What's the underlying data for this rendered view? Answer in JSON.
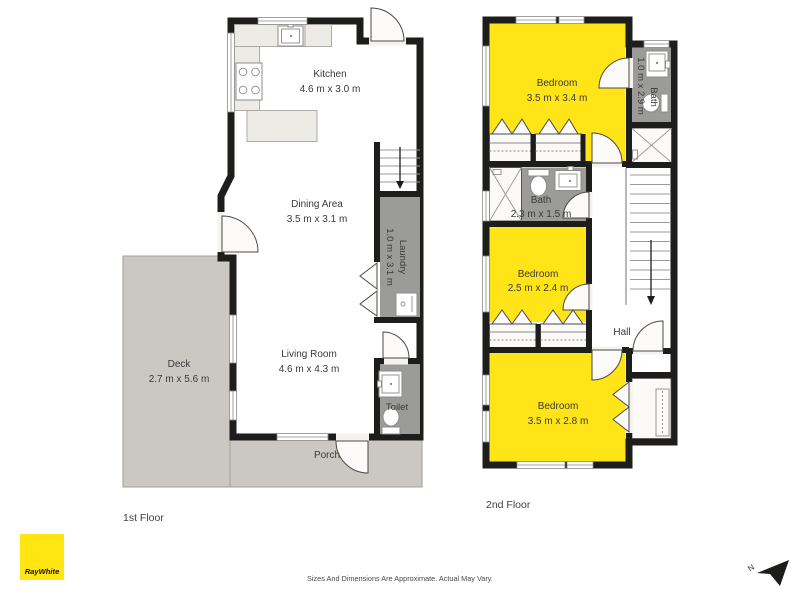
{
  "plan": {
    "floor1": {
      "label": "1st Floor",
      "kitchen": {
        "name": "Kitchen",
        "dims": "4.6 m x 3.0 m"
      },
      "dining": {
        "name": "Dining Area",
        "dims": "3.5 m x 3.1 m"
      },
      "laundry": {
        "name": "Laundry",
        "dims": "1.0 m x 3.1 m"
      },
      "living": {
        "name": "Living Room",
        "dims": "4.6 m x 4.3 m"
      },
      "toilet": {
        "name": "Toilet"
      },
      "deck": {
        "name": "Deck",
        "dims": "2.7 m x 5.6 m"
      },
      "porch": {
        "name": "Porch"
      }
    },
    "floor2": {
      "label": "2nd Floor",
      "bedroom_top": {
        "name": "Bedroom",
        "dims": "3.5 m x 3.4 m"
      },
      "bath_ensuite": {
        "name": "Bath",
        "dims": "1.0 m x 2.9 m"
      },
      "bath_main": {
        "name": "Bath",
        "dims": "2.3 m x 1.5 m"
      },
      "bedroom_middle": {
        "name": "Bedroom",
        "dims": "2.5 m x 2.4 m"
      },
      "hall": {
        "name": "Hall"
      },
      "bedroom_bottom": {
        "name": "Bedroom",
        "dims": "3.5 m x 2.8 m"
      }
    }
  },
  "branding": {
    "logo": "RayWhite",
    "logo_bg": "#FFE512"
  },
  "compass": {
    "north": "N"
  },
  "footer": {
    "disclaimer": "Sizes And Dimensions Are Approximate. Actual May Vary."
  },
  "colors": {
    "room_highlight": "#FFE417",
    "wet_area": "#9B9B99",
    "outdoor": "#CBC8C3",
    "floor": "#F4F3EF",
    "wall": "#1D1D1B"
  }
}
